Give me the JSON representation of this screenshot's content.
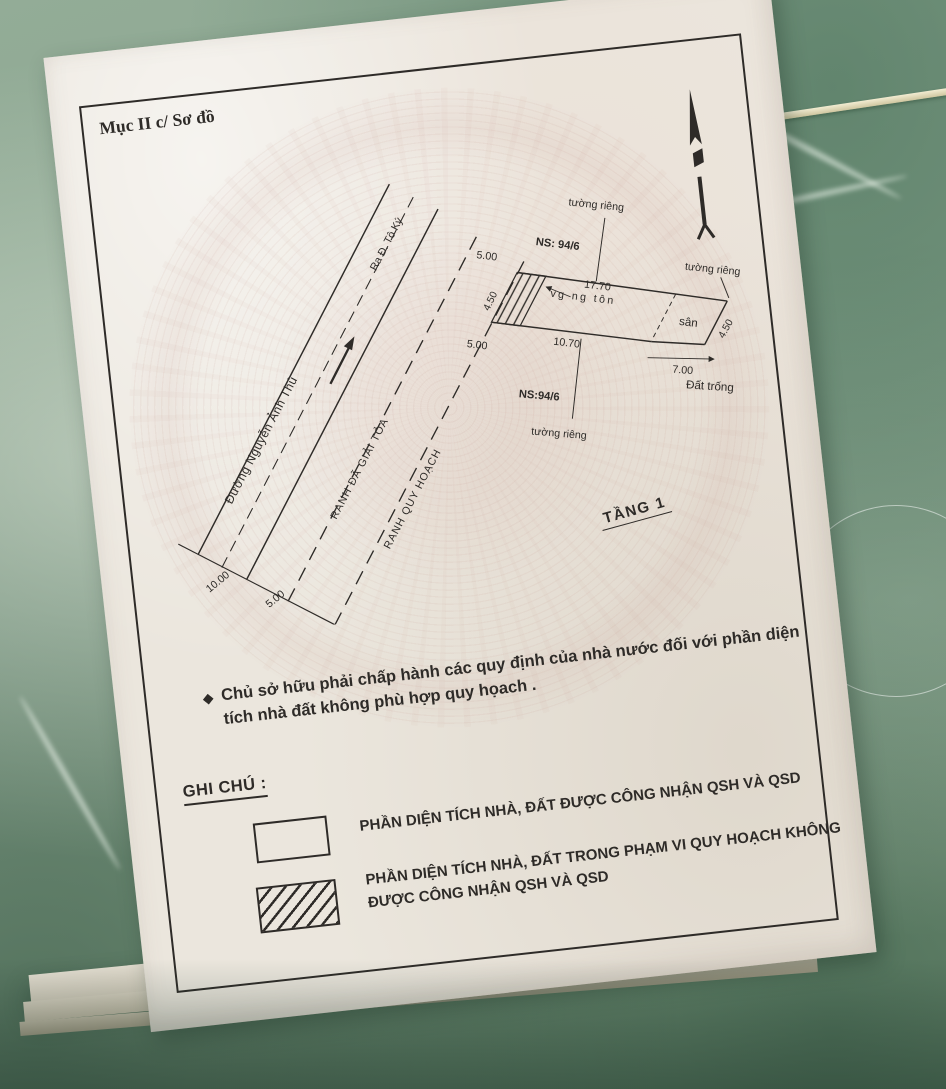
{
  "document": {
    "section_title": "Mục II c/ Sơ đồ",
    "floor_label": "TẦNG 1",
    "note": {
      "bullet": "◆",
      "text": "Chủ sở hữu phải chấp hành các quy định của nhà nước đối với phần diện tích nhà đất không phù hợp quy họach ."
    },
    "legend": {
      "title": "GHI CHÚ :",
      "items": [
        {
          "swatch": "empty-rectangle",
          "label": "PHẦN DIỆN TÍCH NHÀ, ĐẤT ĐƯỢC CÔNG NHẬN QSH VÀ QSD"
        },
        {
          "swatch": "hatched-rectangle",
          "label": "PHẦN DIỆN TÍCH NHÀ, ĐẤT TRONG PHẠM VI QUY HOẠCH KHÔNG ĐƯỢC CÔNG NHẬN QSH VÀ QSD"
        }
      ]
    }
  },
  "site_plan": {
    "street_name": "Đường Nguyễn Ảnh Thủ",
    "direction_label": "Ra Đ. Tô Ký",
    "cleared_boundary": "RANH ĐÃ GIẢI TỎA",
    "planning_boundary": "RANH QUY HOẠCH",
    "house_number_top": "NS: 94/6",
    "house_number_bottom": "NS:94/6",
    "private_wall_label": "tường riêng",
    "yard_label": "sân",
    "empty_land_label": "Đất trống",
    "structure_label": "vg ng tôn",
    "dimensions": {
      "road_width": "10.00",
      "cleared_strip": "5.00",
      "front_top": "5.00",
      "front_bottom": "5.00",
      "front_edge": "4.50",
      "top_edge": "17.70",
      "house_bottom": "10.70",
      "yard_bottom": "7.00",
      "yard_right_edge": "4.50"
    },
    "icons": {
      "north": "north-arrow",
      "note_bullet": "diamond"
    }
  },
  "colors": {
    "paper": "#ebe6dd",
    "ink": "#2e2b28",
    "floor_tile": "#86a18c",
    "watermark": "#c79a8e"
  }
}
